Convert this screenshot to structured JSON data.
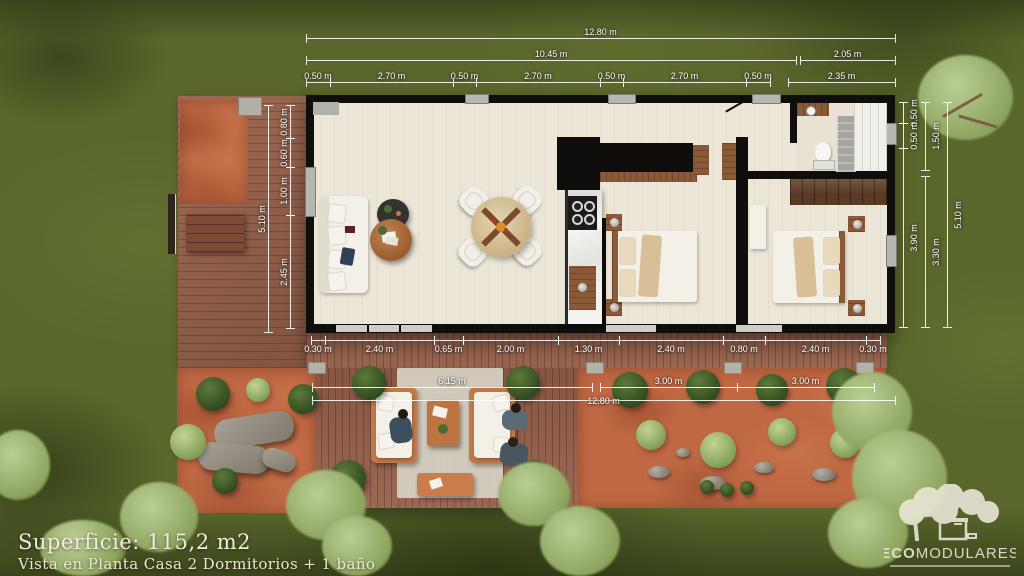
{
  "scene": {
    "type": "architectural-floor-plan-render",
    "colors": {
      "grass": "#5a672c",
      "deck": "#96614a",
      "gravel": "#c06844",
      "floor": "#ece6d8",
      "wall": "#0f0e0c",
      "dim_line": "#ffffff",
      "text": "#f2edda"
    }
  },
  "dims": {
    "top_total": "12.80 m",
    "top_mid": [
      "10.45 m",
      "2.05 m"
    ],
    "top_segments": [
      "0.50 m",
      "2.70 m",
      "0.50 m",
      "2.70 m",
      "0.50 m",
      "2.70 m",
      "0.50 m",
      "2.35 m"
    ],
    "right_inner": [
      "0.50 m",
      "0.50 m",
      "3.90 m"
    ],
    "right_mid": [
      "1.50 m",
      "3.30 m"
    ],
    "right_outer": "5.10 m",
    "left_outer": "5.10 m",
    "left_inner": [
      "0.80 m",
      "0.60 m",
      "1.00 m",
      "2.45 m"
    ],
    "bottom_segments": [
      "0.30 m",
      "2.40 m",
      "0.65 m",
      "2.00 m",
      "1.30 m",
      "2.40 m",
      "0.80 m",
      "2.40 m",
      "0.30 m"
    ],
    "bottom_mid": [
      "6.15 m",
      "3.00 m",
      "3.00 m"
    ],
    "bottom_total": "12.80 m"
  },
  "footer": {
    "superficie": "Superficie:  115,2 m2",
    "subtitle": "Vista en Planta Casa 2 Dormitorios + 1 baño"
  },
  "logo": {
    "eco": "ECO",
    "modulares": "MODULARES"
  }
}
